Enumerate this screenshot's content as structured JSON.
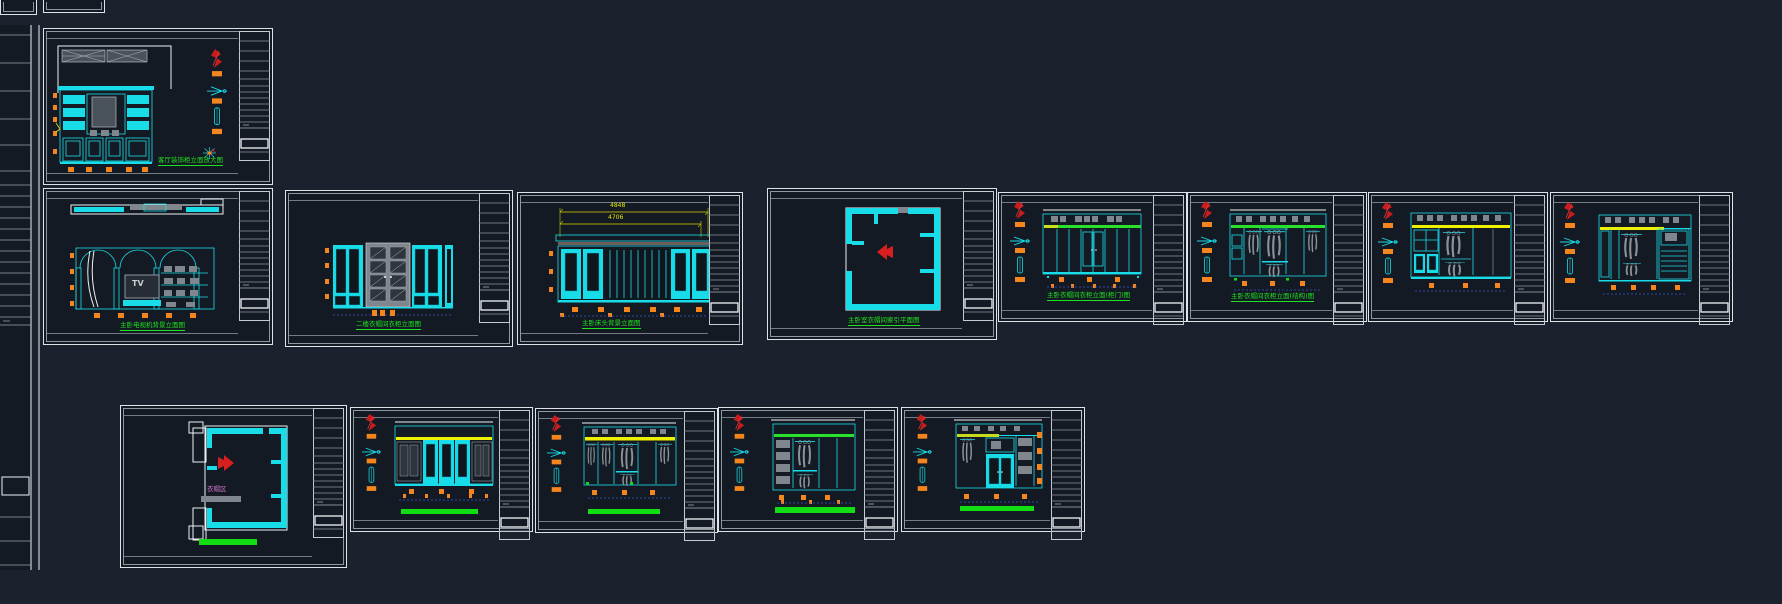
{
  "canvas": {
    "background_color": "#1b212d",
    "sheet_color": "#141a23"
  },
  "palette": {
    "line_cyan": "#19dce9",
    "accent_green": "#1fe11f",
    "accent_yellow": "#efef00",
    "accent_orange": "#f5861f",
    "accent_red": "#d42020",
    "text_magenta": "#d277d2",
    "wall_white": "#eef1f4",
    "frame_gray": "#8f97a1",
    "dim_blue": "#3b55d6"
  },
  "symbols": {
    "index_arrow": "red-chevron-arrow",
    "section_marker": "cyan-plane-marker",
    "elevation_marker": "red-ribbon-marker",
    "scale_capsule": "cyan-capsule-marker"
  },
  "sheets": {
    "bookcase": {
      "caption": "客厅装饰柜立面放大图"
    },
    "tv_wall": {
      "caption": "主卧电视机背景立面图",
      "tv_label": "TV"
    },
    "glass_wardrobe": {
      "caption": "二楼衣帽间衣柜立面图"
    },
    "headboard": {
      "caption": "主卧床头背景立面图",
      "dim_overall": "4848",
      "dim_inner": "4706"
    },
    "master_plan": {
      "caption": "主卧室衣帽间索引平面图"
    },
    "wardrobe_doors": {
      "caption": "主卧衣帽间衣柜立面(柜门)图"
    },
    "wardrobe_structure": {
      "caption": "主卧衣帽间衣柜立面(结构)图"
    },
    "cloakroom_plan": {
      "room_label": "衣帽区"
    }
  }
}
